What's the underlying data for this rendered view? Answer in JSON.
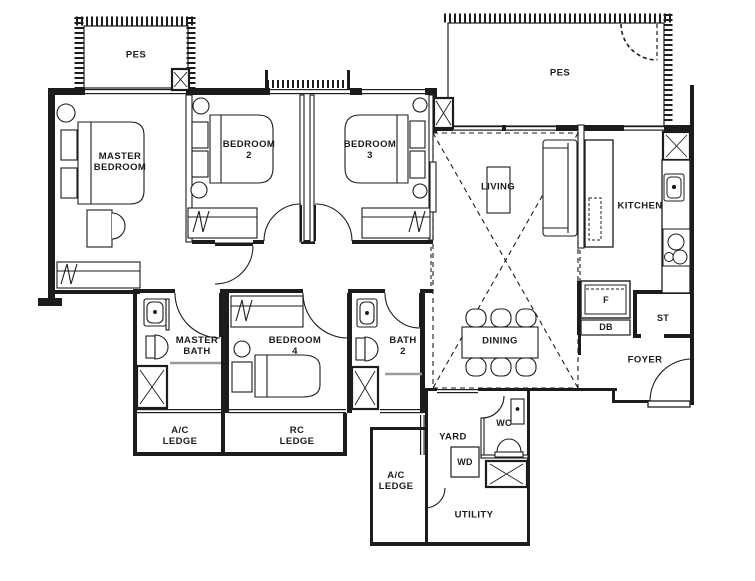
{
  "colors": {
    "line": "#1c1c1c",
    "shower_screen": "#9a9a9a",
    "background": "#ffffff"
  },
  "labels": [
    {
      "id": "pes-left",
      "text": "PES"
    },
    {
      "id": "pes-right",
      "text": "PES"
    },
    {
      "id": "master-bedroom",
      "text": "MASTER\nBEDROOM"
    },
    {
      "id": "bedroom-2",
      "text": "BEDROOM\n2"
    },
    {
      "id": "bedroom-3",
      "text": "BEDROOM\n3"
    },
    {
      "id": "living",
      "text": "LIVING"
    },
    {
      "id": "kitchen",
      "text": "KITCHEN"
    },
    {
      "id": "master-bath",
      "text": "MASTER\nBATH"
    },
    {
      "id": "bedroom-4",
      "text": "BEDROOM\n4"
    },
    {
      "id": "bath-2",
      "text": "BATH\n2"
    },
    {
      "id": "dining",
      "text": "DINING"
    },
    {
      "id": "fridge",
      "text": "F"
    },
    {
      "id": "db",
      "text": "DB"
    },
    {
      "id": "store",
      "text": "ST"
    },
    {
      "id": "foyer",
      "text": "FOYER"
    },
    {
      "id": "ac-ledge-1",
      "text": "A/C\nLEDGE"
    },
    {
      "id": "rc-ledge",
      "text": "RC\nLEDGE"
    },
    {
      "id": "ac-ledge-2",
      "text": "A/C\nLEDGE"
    },
    {
      "id": "yard",
      "text": "YARD"
    },
    {
      "id": "wc",
      "text": "WC"
    },
    {
      "id": "wd",
      "text": "WD"
    },
    {
      "id": "utility",
      "text": "UTILITY"
    }
  ],
  "fixtures": [
    "double-bed",
    "single-bed",
    "wardrobe",
    "toilet",
    "wash-basin",
    "shower-screen",
    "cooker-hob",
    "kitchen-sink",
    "sofa",
    "coffee-table",
    "dining-table",
    "dining-chair",
    "fridge",
    "washer-dryer",
    "ac-unit",
    "door-swing"
  ]
}
